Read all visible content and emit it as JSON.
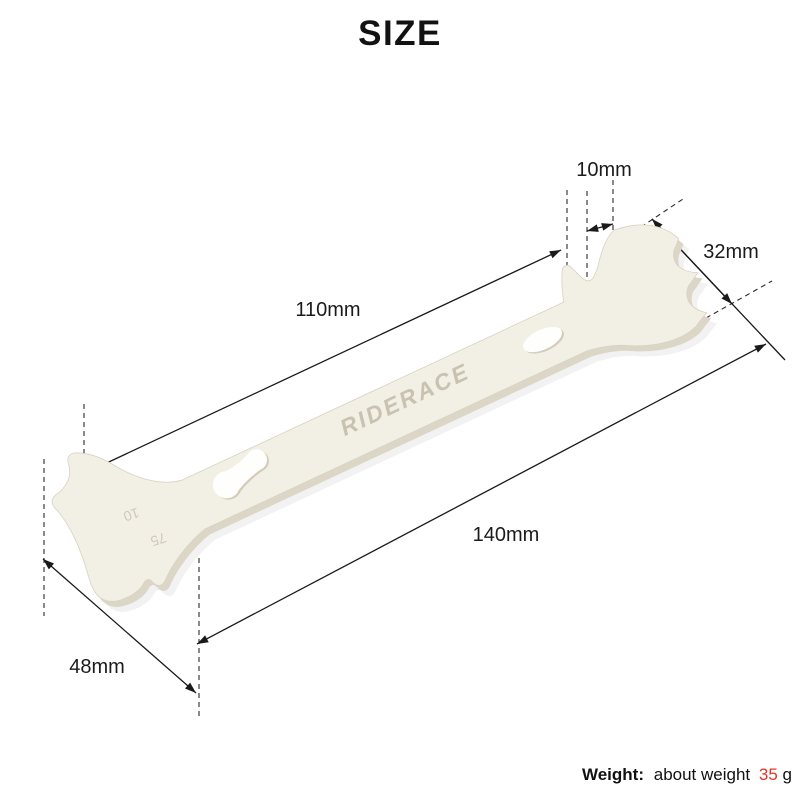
{
  "page": {
    "title": "SIZE"
  },
  "dimensions": {
    "tooth_gap": "10mm",
    "head_width": "32mm",
    "upper_length": "110mm",
    "total_length": "140mm",
    "end_width": "48mm"
  },
  "tool": {
    "brand": "RIDERACE",
    "wear_marking_primary": "10",
    "wear_marking_secondary": "75",
    "body_color": "#f2efe5",
    "edge_color": "#dcd6c7",
    "engraving_color": "#c9c2b0"
  },
  "weight_note": {
    "label": "Weight:",
    "description": "about weight",
    "value": "35",
    "unit": "g",
    "value_color": "#e53528"
  },
  "diagram": {
    "line_color": "#1a1a1a",
    "background": "#ffffff"
  }
}
